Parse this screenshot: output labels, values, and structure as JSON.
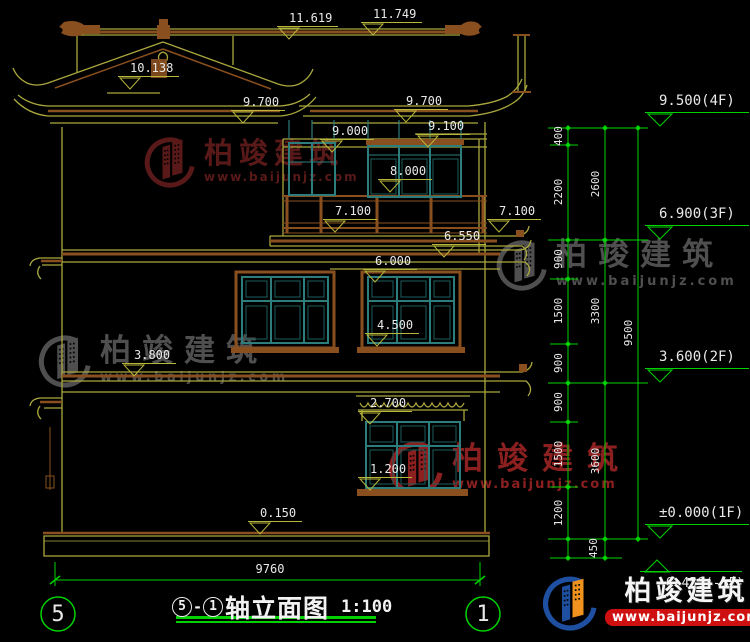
{
  "watermark": {
    "brand": "柏竣建筑",
    "url": "www.baijunjz.com"
  },
  "footer": {
    "brand": "柏竣建筑",
    "url": "www.baijunjz.com"
  },
  "levels": {
    "ridge_top": "11.749",
    "ridge_left": "11.619",
    "gable": "10.138",
    "eave_left": "9.700",
    "eave_right": "9.700",
    "attic_floor_left": "9.000",
    "attic_floor_right": "9.100",
    "loft_sill": "8.000",
    "rail_left": "7.100",
    "rail_right": "7.100",
    "balcony_slab": "6.550",
    "floor3_line": "6.000",
    "window2_sill": "4.500",
    "belt_left": "3.800",
    "canopy": "2.700",
    "window1_sill": "1.200",
    "plinth": "0.150"
  },
  "flags": {
    "f4": "9.500(4F)",
    "f3": "6.900(3F)",
    "f2": "3.600(2F)",
    "f1": "±0.000(1F)",
    "fb": "-0.450(-1F)"
  },
  "chains": {
    "col1": [
      "400",
      "2200",
      "900",
      "1500",
      "900",
      "900",
      "1500",
      "1200"
    ],
    "col2": [
      "2600",
      "3300",
      "3600"
    ],
    "col2b": "450",
    "col3": "9500"
  },
  "dims": {
    "total_width": "9760"
  },
  "axes": {
    "left": "5",
    "right": "1"
  },
  "title": {
    "axis_left": "5",
    "sep": "-",
    "axis_right": "1",
    "name": "轴立面图",
    "scale": "1:100"
  }
}
